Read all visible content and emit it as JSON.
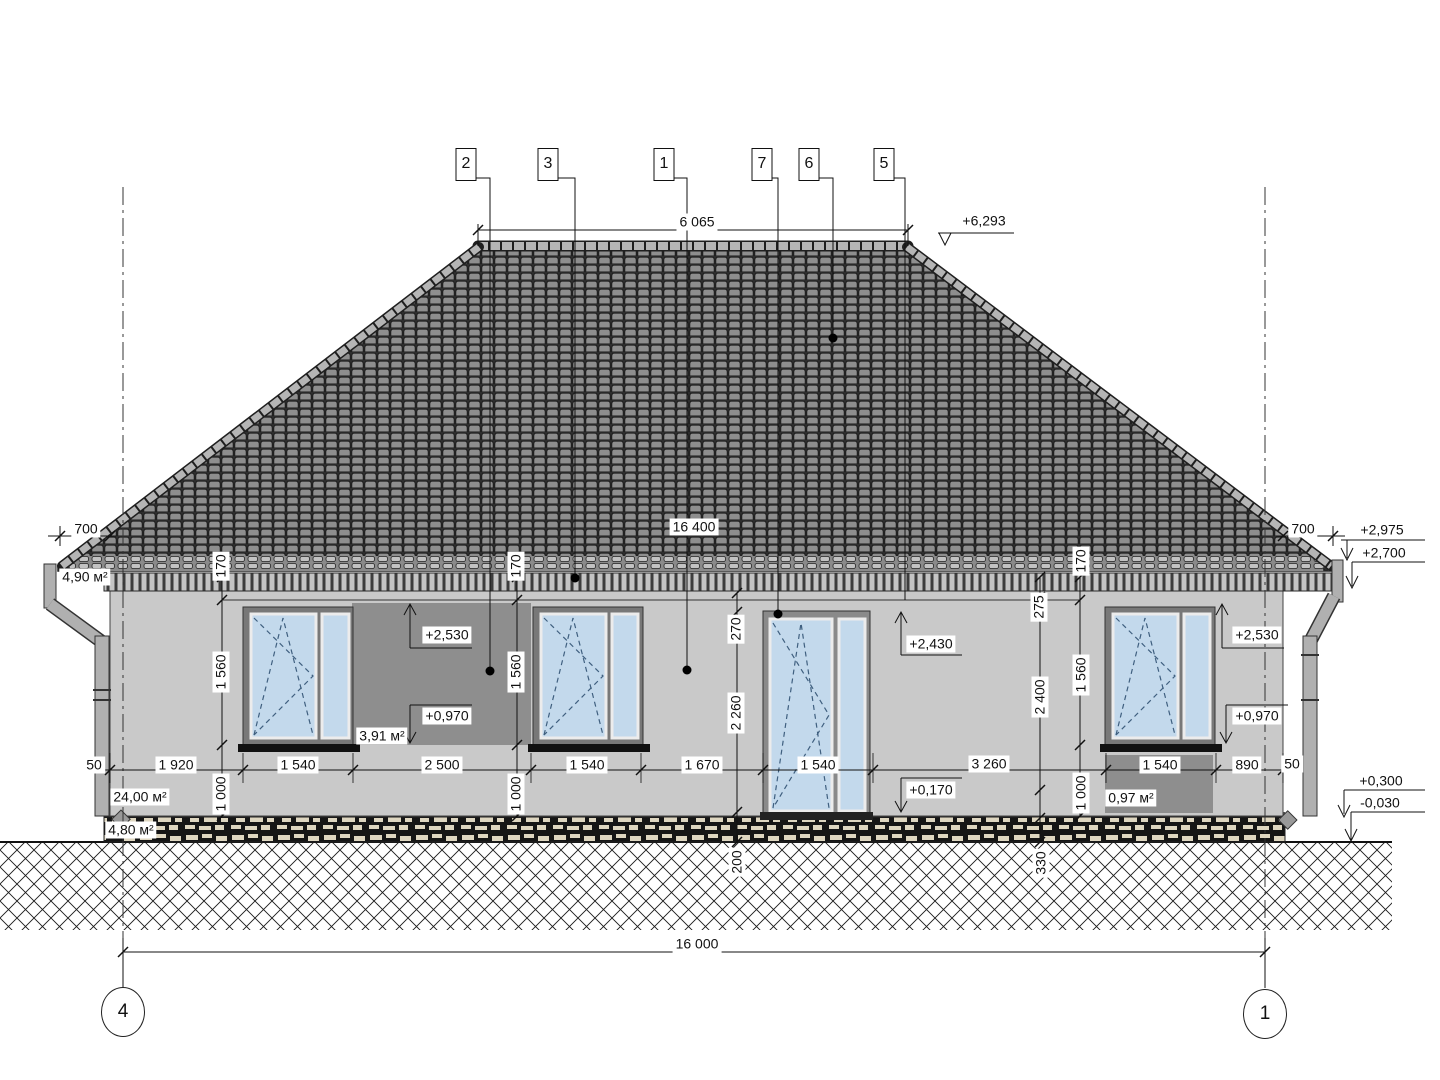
{
  "drawing_type": "house facade elevation (architectural drawing)",
  "axes": {
    "left": "4",
    "right": "1"
  },
  "markers": [
    {
      "name": "marker-2",
      "text": "2",
      "x": 466
    },
    {
      "name": "marker-3",
      "text": "3",
      "x": 548
    },
    {
      "name": "marker-1",
      "text": "1",
      "x": 664
    },
    {
      "name": "marker-7",
      "text": "7",
      "x": 762
    },
    {
      "name": "marker-6",
      "text": "6",
      "x": 809
    },
    {
      "name": "marker-5",
      "text": "5",
      "x": 884
    }
  ],
  "labels": [
    {
      "name": "dim-ridge-6065",
      "text": "6 065",
      "x": 697,
      "y": 222
    },
    {
      "name": "level-plus-6293",
      "text": "+6,293",
      "x": 984,
      "y": 221
    },
    {
      "name": "dim-eaves-16400",
      "text": "16 400",
      "x": 694,
      "y": 527
    },
    {
      "name": "dim-overhang-700-left",
      "text": "700",
      "x": 86,
      "y": 529
    },
    {
      "name": "dim-overhang-700-right",
      "text": "700",
      "x": 1303,
      "y": 529
    },
    {
      "name": "level-plus-2975",
      "text": "+2,975",
      "x": 1382,
      "y": 530
    },
    {
      "name": "level-plus-2700",
      "text": "+2,700",
      "x": 1384,
      "y": 553
    },
    {
      "name": "area-roof-4-90",
      "text": "4,90 м²",
      "x": 85,
      "y": 577
    },
    {
      "name": "dim-170-left",
      "text": "170",
      "x": 221,
      "y": 566,
      "rot": true
    },
    {
      "name": "dim-170-mid",
      "text": "170",
      "x": 516,
      "y": 566,
      "rot": true
    },
    {
      "name": "dim-170-right",
      "text": "170",
      "x": 1081,
      "y": 561,
      "rot": true
    },
    {
      "name": "dim-1560-left",
      "text": "1 560",
      "x": 221,
      "y": 672,
      "rot": true
    },
    {
      "name": "dim-1560-mid",
      "text": "1 560",
      "x": 516,
      "y": 672,
      "rot": true
    },
    {
      "name": "dim-1560-right",
      "text": "1 560",
      "x": 1081,
      "y": 675,
      "rot": true
    },
    {
      "name": "dim-1000-left",
      "text": "1 000",
      "x": 221,
      "y": 794,
      "rot": true
    },
    {
      "name": "dim-1000-mid",
      "text": "1 000",
      "x": 516,
      "y": 794,
      "rot": true
    },
    {
      "name": "dim-1000-right",
      "text": "1 000",
      "x": 1081,
      "y": 793,
      "rot": true
    },
    {
      "name": "level-plus-2530-left",
      "text": "+2,530",
      "x": 447,
      "y": 635
    },
    {
      "name": "level-plus-0970-left",
      "text": "+0,970",
      "x": 447,
      "y": 716
    },
    {
      "name": "area-panel-3-91",
      "text": "3,91 м²",
      "x": 382,
      "y": 736
    },
    {
      "name": "level-plus-2530-right",
      "text": "+2,530",
      "x": 1257,
      "y": 635
    },
    {
      "name": "level-plus-0970-right",
      "text": "+0,970",
      "x": 1257,
      "y": 716
    },
    {
      "name": "dim-270-door",
      "text": "270",
      "x": 736,
      "y": 629,
      "rot": true
    },
    {
      "name": "dim-2260-door",
      "text": "2 260",
      "x": 736,
      "y": 713,
      "rot": true
    },
    {
      "name": "level-plus-2430",
      "text": "+2,430",
      "x": 931,
      "y": 644
    },
    {
      "name": "level-plus-0170",
      "text": "+0,170",
      "x": 931,
      "y": 790
    },
    {
      "name": "dim-275",
      "text": "275",
      "x": 1039,
      "y": 607,
      "rot": true
    },
    {
      "name": "dim-2400",
      "text": "2 400",
      "x": 1040,
      "y": 697,
      "rot": true
    },
    {
      "name": "dim-50-left",
      "text": "50",
      "x": 94,
      "y": 765
    },
    {
      "name": "dim-1920",
      "text": "1 920",
      "x": 176,
      "y": 765
    },
    {
      "name": "dim-1540-window1",
      "text": "1 540",
      "x": 298,
      "y": 765
    },
    {
      "name": "dim-2500",
      "text": "2 500",
      "x": 442,
      "y": 765
    },
    {
      "name": "dim-1540-window2",
      "text": "1 540",
      "x": 587,
      "y": 765
    },
    {
      "name": "dim-1670",
      "text": "1 670",
      "x": 702,
      "y": 765
    },
    {
      "name": "dim-1540-door",
      "text": "1 540",
      "x": 818,
      "y": 765
    },
    {
      "name": "dim-3260",
      "text": "3 260",
      "x": 989,
      "y": 764
    },
    {
      "name": "dim-1540-window3",
      "text": "1 540",
      "x": 1160,
      "y": 765
    },
    {
      "name": "dim-890",
      "text": "890",
      "x": 1247,
      "y": 765
    },
    {
      "name": "dim-50-right",
      "text": "50",
      "x": 1292,
      "y": 764
    },
    {
      "name": "area-wall-24-00",
      "text": "24,00 м²",
      "x": 140,
      "y": 797
    },
    {
      "name": "area-panel-0-97",
      "text": "0,97 м²",
      "x": 1131,
      "y": 798
    },
    {
      "name": "area-plinth-4-80",
      "text": "4,80 м²",
      "x": 131,
      "y": 830
    },
    {
      "name": "level-plus-0300",
      "text": "+0,300",
      "x": 1381,
      "y": 781
    },
    {
      "name": "level-minus-0030",
      "text": "-0,030",
      "x": 1380,
      "y": 803
    },
    {
      "name": "dim-200-ground",
      "text": "200",
      "x": 737,
      "y": 862,
      "rot": true
    },
    {
      "name": "dim-330-ground",
      "text": "330",
      "x": 1041,
      "y": 863,
      "rot": true
    },
    {
      "name": "dim-total-16000",
      "text": "16 000",
      "x": 697,
      "y": 944
    }
  ],
  "colors": {
    "wall": "#c9c9c9",
    "panel": "#8e8e8e",
    "glass": "#c3d9ec",
    "frame": "#787878",
    "roof_tile": "#8e8e8e",
    "roof_gap": "#2e2e2e",
    "ridge": "#b5b5b5",
    "plinth_stone": "#ded6c0",
    "plinth_bg": "#151515",
    "line": "#111111",
    "sash": "#ececec",
    "pipe": "#b0b0b0",
    "dash": "#3f5f7f"
  }
}
